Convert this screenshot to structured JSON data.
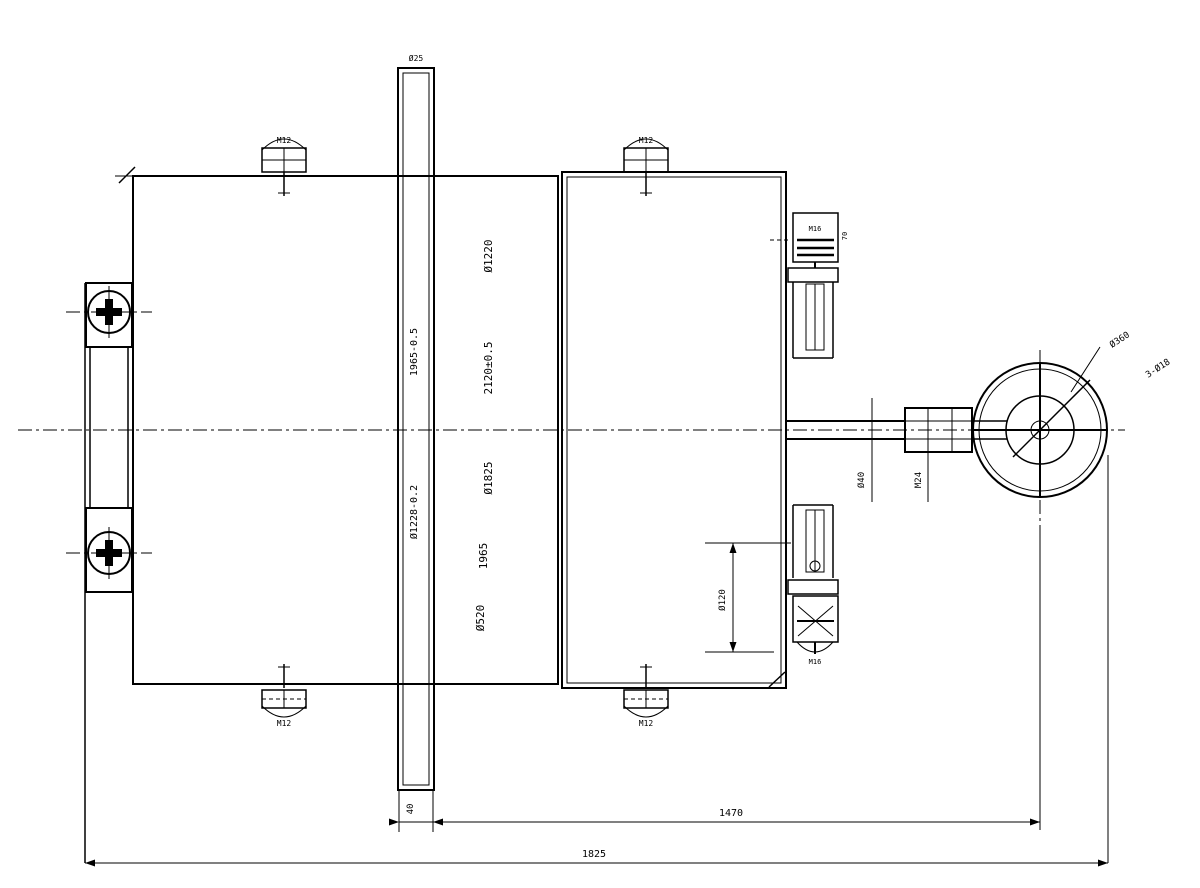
{
  "drawing": {
    "type": "mechanical-assembly-drawing",
    "description": "CAD line drawing of a gate / frame assembly with guide rollers, screw stem brackets, shaft coupling and handwheel",
    "colors": {
      "background": "#ffffff",
      "ink": "#000000"
    }
  },
  "annotations": {
    "plate_top_mark": "Ø25",
    "plate_dim_upper": "1965-0.5",
    "plate_dim_lower": "Ø1228-0.2",
    "plate_thickness_dim": "40",
    "center_dim_1": "Ø1220",
    "center_dim_2": "2120±0.5",
    "center_dim_3": "Ø1825",
    "center_dim_4": "1965",
    "center_dim_5": "Ø520",
    "clamp_top_left": "M12",
    "clamp_top_right": "M12",
    "clamp_bottom_left": "M12",
    "clamp_bottom_right": "M12",
    "bracket_top_inner": "M16",
    "bracket_top_side": "70",
    "bracket_bottom_note": "M16",
    "bracket_bottom_dim": "Ø120",
    "shaft_dim": "Ø40",
    "coupling_dim": "M24",
    "wheel_note_1": "Ø360",
    "wheel_note_2": "3-Ø18",
    "dim_inner_span": "1470",
    "dim_overall_span": "1825"
  }
}
